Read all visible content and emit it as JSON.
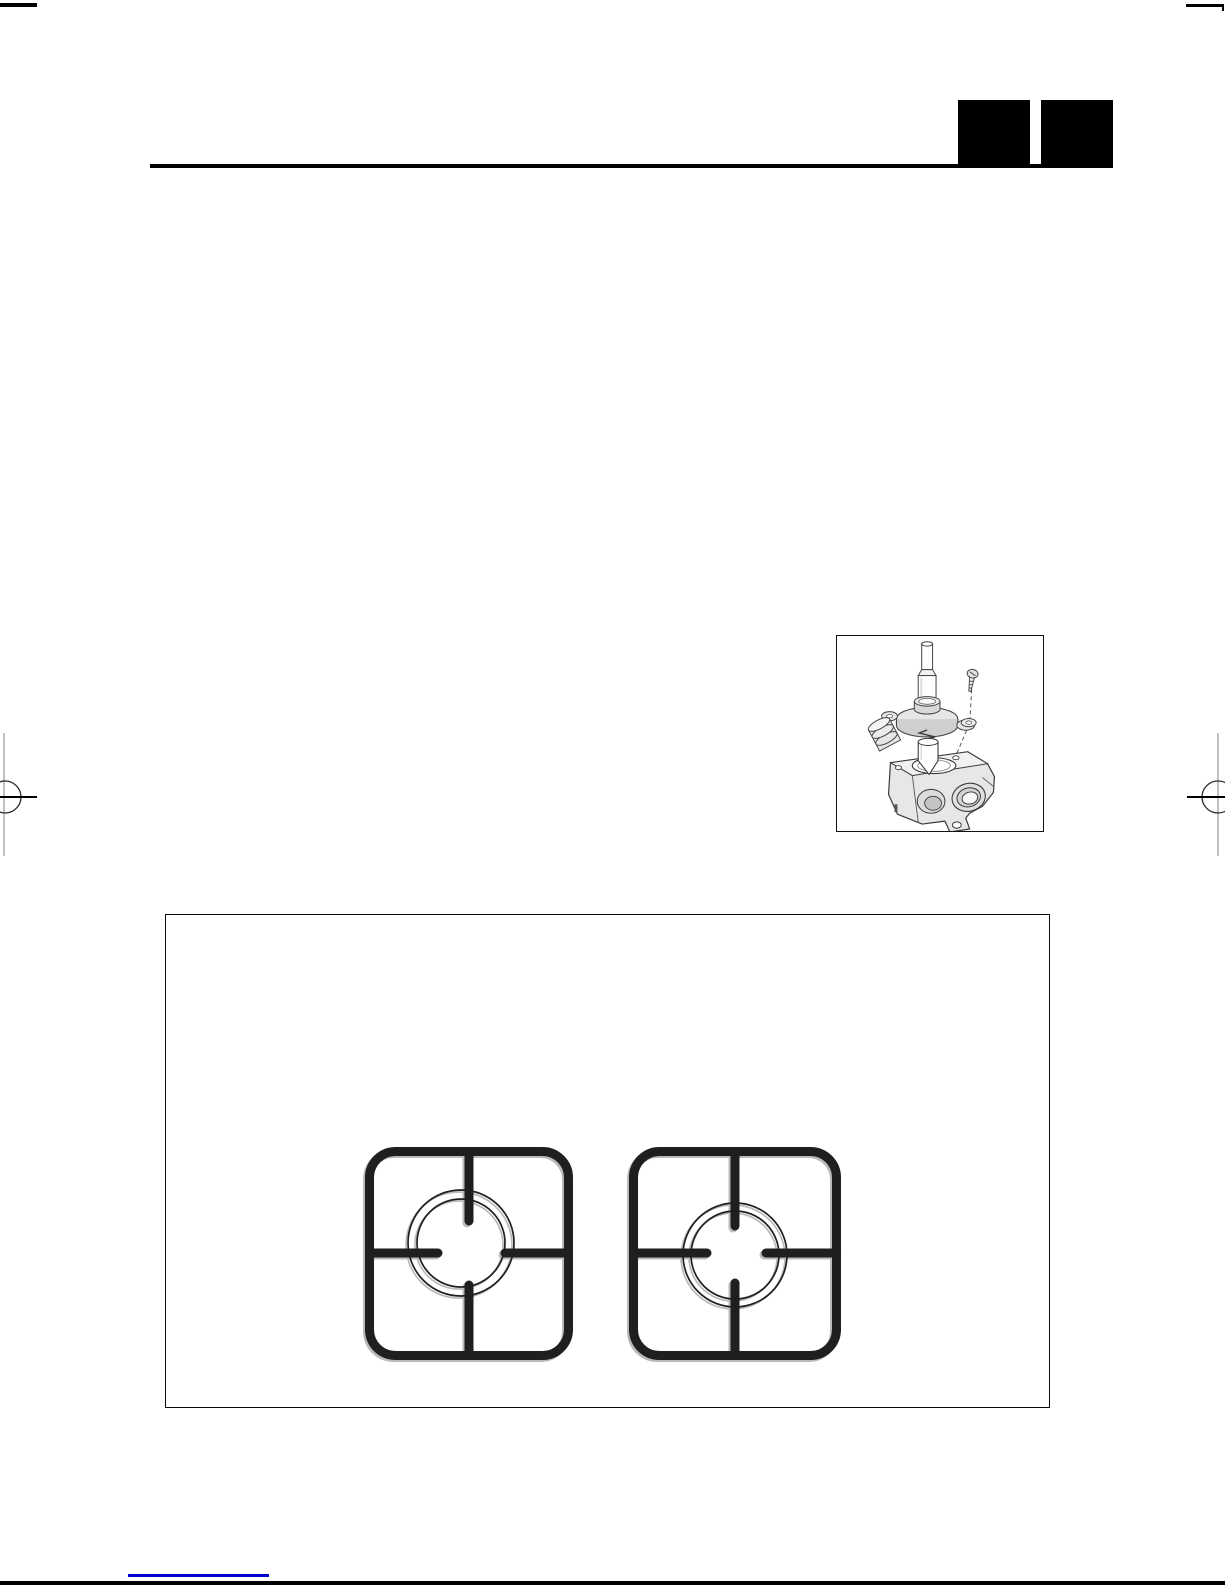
{
  "colors": {
    "paper": "#ffffff",
    "ink": "#000000",
    "line-art": "#3a3a3a",
    "grate-ink": "#1f1f1f",
    "link-blue": "#0000cc",
    "reg-gray": "#b0b0b0"
  },
  "header": {
    "rule": "horizontal-title-rule",
    "redaction_blocks": [
      {
        "id": "chapter-block-1"
      },
      {
        "id": "chapter-block-2"
      }
    ]
  },
  "figures": {
    "gas_tap": {
      "name": "gas-tap-exploded-diagram",
      "parts": [
        "stem",
        "fixing-screw",
        "guide-dashed-line",
        "bonnet-flange",
        "washer",
        "spring",
        "taper-plug",
        "valve-body",
        "inlet-port",
        "outlet-ring",
        "mounting-tab"
      ]
    },
    "pan_supports": {
      "name": "pan-support-grids",
      "left_grate": {
        "name": "pan-support-deep-fingers"
      },
      "right_grate": {
        "name": "pan-support-short-fingers"
      }
    }
  },
  "print_marks": {
    "top_left": "trim-tick",
    "top_right": "trim-tick",
    "left_center": "registration-target",
    "right_center": "registration-target",
    "bottom": "page-edge-bar",
    "footer_link": "link-underline"
  }
}
